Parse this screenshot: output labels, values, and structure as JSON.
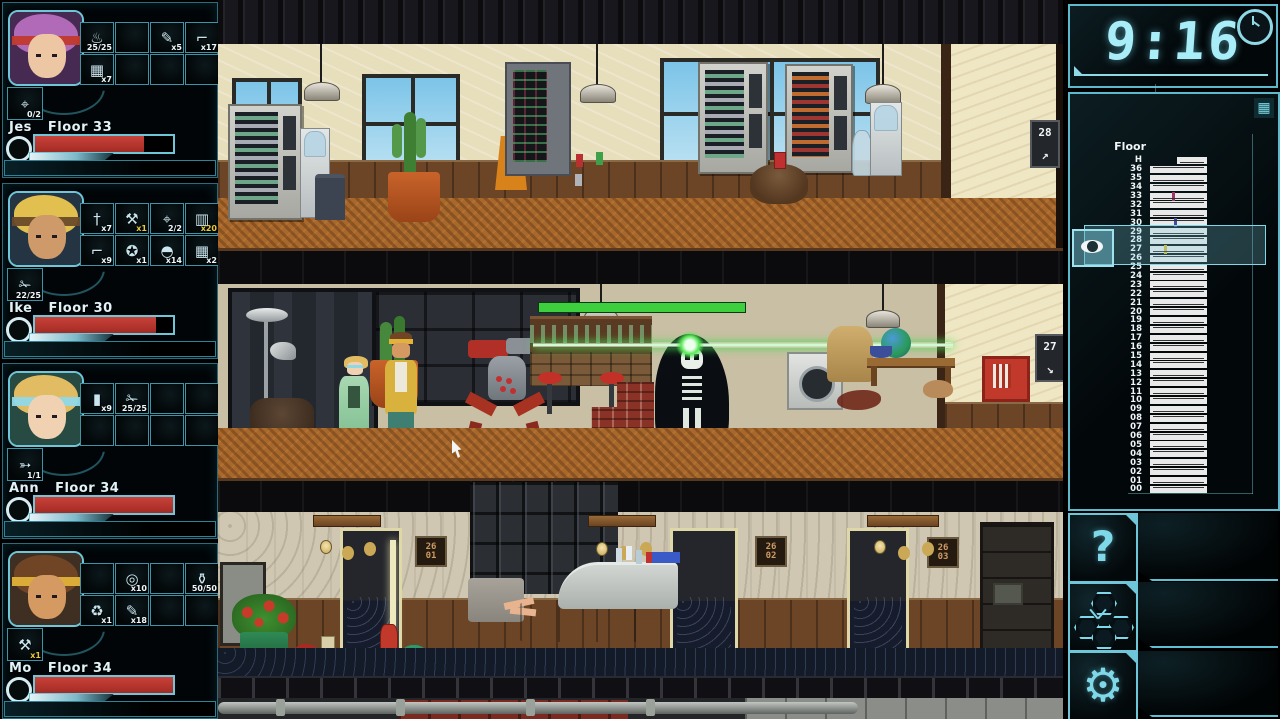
{
  "ui_colors": {
    "accent_cyan": "#6fc6d8",
    "hp_red": "#b23128",
    "count_highlight_yellow": "#e9c93c",
    "enemy_hp_green": "#3ecf3e",
    "laser_green": "#54e854"
  },
  "party": [
    {
      "name": "Jes",
      "floor_label": "Floor 33",
      "hp_pct": 79,
      "weapon": {
        "icon": "pistol",
        "count": "0/2",
        "highlight": false
      },
      "items": [
        {
          "slot": 0,
          "icon": "camping-stove",
          "count": "25/25",
          "highlight": false
        },
        {
          "slot": 2,
          "icon": "screw",
          "count": "x5",
          "highlight": false
        },
        {
          "slot": 3,
          "icon": "prybar",
          "count": "x17",
          "highlight": false
        },
        {
          "slot": 4,
          "icon": "circuit-board",
          "count": "x7",
          "highlight": false
        }
      ],
      "colors": {
        "bg": "#472a52",
        "hair": "#b06ab8",
        "skin": "#edc6a4",
        "accent": "#c23a2c"
      }
    },
    {
      "name": "Ike",
      "floor_label": "Floor 30",
      "hp_pct": 88,
      "weapon": {
        "icon": "chainsaw",
        "count": "22/25",
        "highlight": false
      },
      "items": [
        {
          "slot": 0,
          "icon": "knife",
          "count": "x7",
          "highlight": false
        },
        {
          "slot": 1,
          "icon": "axe",
          "count": "x1",
          "highlight": true
        },
        {
          "slot": 2,
          "icon": "pistol",
          "count": "2/2",
          "highlight": false
        },
        {
          "slot": 3,
          "icon": "canned-food",
          "count": "x20",
          "highlight": true
        },
        {
          "slot": 4,
          "icon": "crowbar",
          "count": "x9",
          "highlight": false
        },
        {
          "slot": 5,
          "icon": "apple",
          "count": "x1",
          "highlight": false
        },
        {
          "slot": 6,
          "icon": "opened-can",
          "count": "x14",
          "highlight": false
        },
        {
          "slot": 7,
          "icon": "circuit-board",
          "count": "x2",
          "highlight": false
        }
      ],
      "colors": {
        "bg": "#243442",
        "hair": "#e2c050",
        "skin": "#cf9a6a",
        "accent": "#6a4a2a"
      }
    },
    {
      "name": "Ann",
      "floor_label": "Floor 34",
      "hp_pct": 100,
      "weapon": {
        "icon": "rifle",
        "count": "1/1",
        "highlight": false
      },
      "items": [
        {
          "slot": 0,
          "icon": "bullet",
          "count": "x9",
          "highlight": false
        },
        {
          "slot": 1,
          "icon": "chainsaw",
          "count": "25/25",
          "highlight": false
        }
      ],
      "colors": {
        "bg": "#274a42",
        "hair": "#e2bc62",
        "skin": "#f0d2b2",
        "accent": "#8fd8e8"
      }
    },
    {
      "name": "Mo",
      "floor_label": "Floor 34",
      "hp_pct": 100,
      "weapon": {
        "icon": "axe",
        "count": "x1",
        "highlight": true
      },
      "items": [
        {
          "slot": 1,
          "icon": "duct-tape",
          "count": "x10",
          "highlight": false
        },
        {
          "slot": 3,
          "icon": "gas-tank",
          "count": "50/50",
          "highlight": false
        },
        {
          "slot": 4,
          "icon": "pine-freshener",
          "count": "x1",
          "highlight": false
        },
        {
          "slot": 5,
          "icon": "screw",
          "count": "x18",
          "highlight": false
        }
      ],
      "colors": {
        "bg": "#3f2f22",
        "hair": "#6f4526",
        "skin": "#d59a62",
        "accent": "#e2b23a"
      }
    }
  ],
  "hud": {
    "clock": {
      "time": "9:16",
      "icon": "analog-clock"
    },
    "floor_map": {
      "header": "Floor",
      "icon": "building",
      "floors": [
        "H",
        "36",
        "35",
        "34",
        "33",
        "32",
        "31",
        "30",
        "29",
        "28",
        "27",
        "26",
        "25",
        "24",
        "23",
        "22",
        "21",
        "20",
        "19",
        "18",
        "17",
        "16",
        "15",
        "14",
        "13",
        "12",
        "11",
        "10",
        "09",
        "08",
        "07",
        "06",
        "05",
        "04",
        "03",
        "02",
        "01",
        "00"
      ],
      "markers": [
        {
          "floor": "33",
          "color": "#9b3767",
          "pos_pct": 38
        },
        {
          "floor": "30",
          "color": "#3f4f9f",
          "pos_pct": 42
        },
        {
          "floor": "27",
          "color": "#d4b632",
          "pos_pct": 24
        }
      ],
      "highlight_floors": [
        "29",
        "28",
        "27",
        "26"
      ],
      "eye_button": {
        "icon": "eye"
      }
    },
    "buttons": [
      {
        "id": "help",
        "label": "?",
        "icon": "question-mark"
      },
      {
        "id": "skills",
        "label": "",
        "icon": "hex-cluster"
      },
      {
        "id": "settings",
        "label": "",
        "icon": "gear"
      }
    ]
  },
  "game": {
    "elevator_plates": [
      {
        "floor": "28",
        "arrow": "↗"
      },
      {
        "floor": "27",
        "arrow": "↘"
      }
    ],
    "door_signs": [
      {
        "line1": "26",
        "line2": "01"
      },
      {
        "line1": "26",
        "line2": "02"
      },
      {
        "line1": "26",
        "line2": "03"
      }
    ],
    "enemies": [
      {
        "name": "skeleton",
        "hp_pct": 100
      },
      {
        "name": "laser-robot"
      }
    ]
  }
}
